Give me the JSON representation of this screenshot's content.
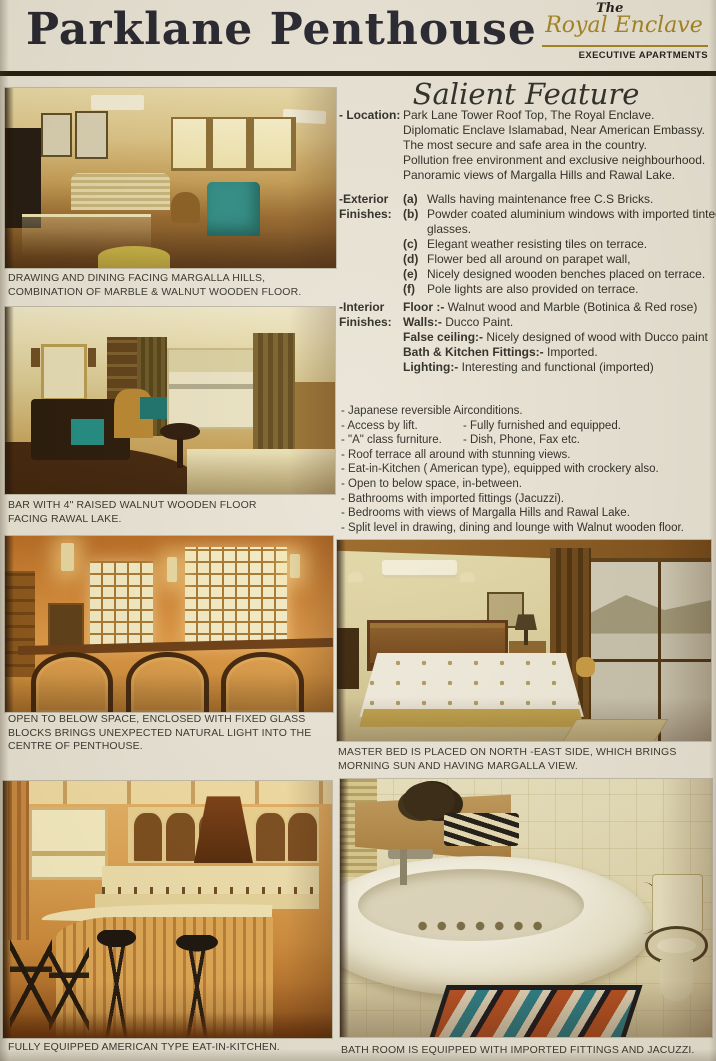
{
  "palette": {
    "gold": "#a3831e",
    "ink": "#23222c",
    "paper": "#e9e4d6",
    "photo_warm": "#d08432",
    "teal_accent": "#2d8c84"
  },
  "header": {
    "title": "Parklane Penthouse",
    "logo_the": "The",
    "logo_name": "Royal Enclave",
    "logo_subtitle": "EXECUTIVE APARTMENTS"
  },
  "salient": {
    "heading": "Salient Feature",
    "location_label": "- Location:",
    "location_lines": [
      "Park Lane Tower Roof Top, The Royal Enclave.",
      "Diplomatic Enclave Islamabad, Near American Embassy.",
      "The most secure and safe area in the country.",
      "Pollution free environment and exclusive neighbourhood.",
      "Panoramic views of Margalla Hills and Rawal Lake."
    ],
    "exterior_label_1": "-Exterior",
    "exterior_label_2": "Finishes:",
    "exterior_items": [
      {
        "key": "(a)",
        "text": "Walls having maintenance free C.S Bricks."
      },
      {
        "key": "(b)",
        "text": "Powder coated aluminium windows with imported tinted glasses."
      },
      {
        "key": "(c)",
        "text": "Elegant weather resisting tiles on terrace."
      },
      {
        "key": "(d)",
        "text": "Flower bed all around on parapet wall,"
      },
      {
        "key": "(e)",
        "text": "Nicely designed wooden benches placed on terrace."
      },
      {
        "key": "(f)",
        "text": "Pole lights are also provided on terrace."
      }
    ],
    "interior_label_1": "-Interior",
    "interior_label_2": "Finishes:",
    "interior_items": [
      {
        "key": "Floor :-",
        "text": "Walnut wood and Marble (Botinica & Red rose)"
      },
      {
        "key": "Walls:-",
        "text": "Ducco Paint."
      },
      {
        "key": "False ceiling:-",
        "text": "Nicely designed of wood with Ducco  paint"
      },
      {
        "key": "Bath & Kitchen Fittings:-",
        "text": "Imported."
      },
      {
        "key": "Lighting:-",
        "text": "Interesting and functional (imported)"
      }
    ],
    "features": [
      {
        "left": "- Japanese reversible Airconditions.",
        "right": ""
      },
      {
        "left": "- Access by lift.",
        "right": "- Fully furnished and equipped."
      },
      {
        "left": "- \"A\" class furniture.",
        "right": "- Dish, Phone, Fax etc."
      },
      {
        "left": "- Roof terrace all around with stunning views.",
        "right": ""
      },
      {
        "left": "- Eat-in-Kitchen ( American type), equipped with crockery also.",
        "right": ""
      },
      {
        "left": "- Open to below space, in-between.",
        "right": ""
      },
      {
        "left": "- Bathrooms with imported fittings (Jacuzzi).",
        "right": ""
      },
      {
        "left": "- Bedrooms with views of Margalla Hills and Rawal Lake.",
        "right": ""
      },
      {
        "left": "- Split level in drawing, dining and lounge with Walnut wooden floor.",
        "right": ""
      }
    ]
  },
  "captions": {
    "drawing_dining": "DRAWING AND DINING FACING MARGALLA HILLS,\nCOMBINATION OF MARBLE & WALNUT WOODEN FLOOR.",
    "bar": "BAR WITH 4\" RAISED WALNUT WOODEN FLOOR\nFACING RAWAL LAKE.",
    "open_below": "OPEN TO BELOW SPACE, ENCLOSED WITH FIXED GLASS\nBLOCKS BRINGS UNEXPECTED NATURAL LIGHT INTO THE\nCENTRE OF PENTHOUSE.",
    "kitchen": "FULLY EQUIPPED AMERICAN TYPE EAT-IN-KITCHEN.",
    "master_bed": "MASTER BED IS PLACED ON NORTH -EAST SIDE, WHICH BRINGS\nMORNING SUN AND HAVING MARGALLA VIEW.",
    "bathroom": "BATH ROOM IS EQUIPPED WITH IMPORTED FITTINGS AND JACUZZI."
  }
}
